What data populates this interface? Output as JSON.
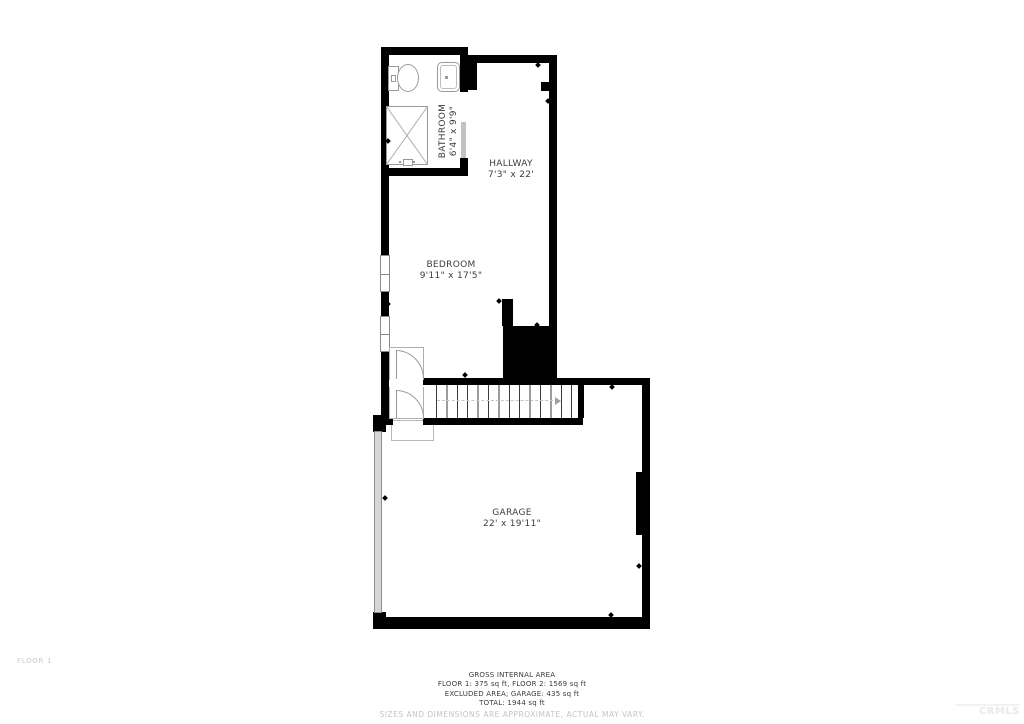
{
  "plan": {
    "floor_label": "FLOOR 1",
    "rooms": [
      {
        "id": "bathroom",
        "name": "BATHROOM",
        "dims": "6'4\" x 9'9\""
      },
      {
        "id": "hallway",
        "name": "HALLWAY",
        "dims": "7'3\" x 22'"
      },
      {
        "id": "bedroom",
        "name": "BEDROOM",
        "dims": "9'11\" x 17'5\""
      },
      {
        "id": "garage",
        "name": "GARAGE",
        "dims": "22' x 19'11\""
      }
    ],
    "fixture_names": [
      "toilet",
      "sink",
      "shower",
      "pocket-door",
      "window",
      "window",
      "bedroom-door",
      "entry-door",
      "entry-step",
      "stairs",
      "stair-direction-arrow",
      "garage-door"
    ]
  },
  "footer": {
    "area_title": "GROSS INTERNAL AREA",
    "area_line1": "FLOOR 1: 375 sq ft, FLOOR 2: 1569 sq ft",
    "area_line2": "EXCLUDED AREA; GARAGE: 435 sq ft",
    "area_line3": "TOTAL: 1944 sq ft",
    "disclaimer": "SIZES AND DIMENSIONS ARE APPROXIMATE, ACTUAL MAY VARY."
  },
  "watermark": "CRMLS",
  "colors": {
    "wall": "#000000",
    "fixture_outline": "#9a9a9a",
    "door_slide_panel": "#c2c2c2",
    "garage_door_panel": "#d6d6d6",
    "label_text": "#3d3d3d",
    "muted_text": "#c4c4c4",
    "watermark_text": "#e9e9e9"
  }
}
